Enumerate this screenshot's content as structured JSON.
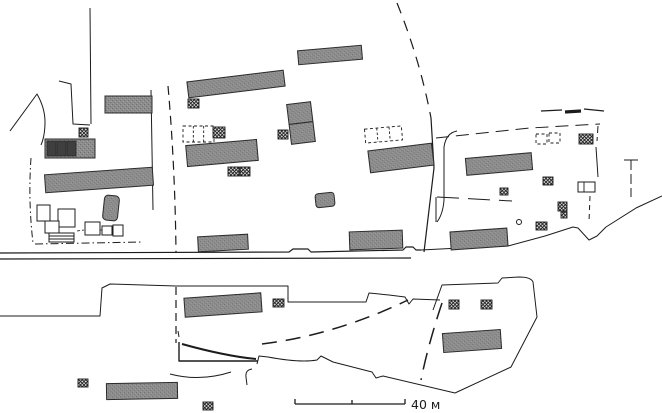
{
  "page": {
    "background": "#ffffff"
  },
  "map": {
    "width": 662,
    "height": 413,
    "colors": {
      "line": "#1c1c1c",
      "building_fill": "#8d8d8d",
      "building_noise": "#6f6f6f",
      "building_stroke": "#2b2b2b",
      "cell_fill": "#3f3f3f",
      "marker_bg": "#d6d6d6",
      "marker_line": "#1c1c1c",
      "open_fill": "#ffffff"
    },
    "scale_bar": {
      "label": "40 м",
      "bar_path": "M295,404 L405,404 M295,404 L295,399 M352,404 L352,400 M405,404 L405,399"
    },
    "buildings": [
      {
        "cx": 128.5,
        "cy": 104.5,
        "w": 47,
        "h": 17,
        "rot": 0
      },
      {
        "cx": 70,
        "cy": 148.5,
        "w": 50,
        "h": 19,
        "rot": 0
      },
      {
        "cx": 99,
        "cy": 180,
        "w": 108,
        "h": 18,
        "rot": -4
      },
      {
        "cx": 111,
        "cy": 208,
        "w": 15,
        "h": 25,
        "rot": 6,
        "rx": 4
      },
      {
        "cx": 236,
        "cy": 84,
        "w": 97,
        "h": 16,
        "rot": -7
      },
      {
        "cx": 222,
        "cy": 153,
        "w": 71,
        "h": 21,
        "rot": -5
      },
      {
        "cx": 330,
        "cy": 55,
        "w": 64,
        "h": 14,
        "rot": -5
      },
      {
        "cx": 301,
        "cy": 123,
        "w": 24,
        "h": 40,
        "rot": -7,
        "divider": true
      },
      {
        "cx": 401,
        "cy": 158,
        "w": 64,
        "h": 22,
        "rot": -7
      },
      {
        "cx": 499,
        "cy": 164,
        "w": 66,
        "h": 17,
        "rot": -5
      },
      {
        "cx": 376,
        "cy": 240,
        "w": 53,
        "h": 18,
        "rot": -2
      },
      {
        "cx": 479,
        "cy": 239,
        "w": 57,
        "h": 18,
        "rot": -4
      },
      {
        "cx": 223,
        "cy": 243,
        "w": 50,
        "h": 15,
        "rot": -3
      },
      {
        "cx": 223,
        "cy": 305,
        "w": 77,
        "h": 19,
        "rot": -4
      },
      {
        "cx": 472,
        "cy": 341,
        "w": 58,
        "h": 19,
        "rot": -4
      },
      {
        "cx": 142,
        "cy": 391,
        "w": 71,
        "h": 16,
        "rot": -1
      },
      {
        "cx": 325,
        "cy": 200,
        "w": 19,
        "h": 14,
        "rot": -6,
        "rx": 3
      }
    ],
    "building_cells": [
      {
        "x": 47,
        "y": 141,
        "w": 9,
        "h": 15
      },
      {
        "x": 57,
        "y": 141,
        "w": 9,
        "h": 15
      },
      {
        "x": 67,
        "y": 141,
        "w": 9,
        "h": 15
      }
    ],
    "markers": [
      {
        "x": 79,
        "y": 128,
        "w": 9,
        "h": 9
      },
      {
        "x": 188,
        "y": 99,
        "w": 11,
        "h": 9
      },
      {
        "x": 213,
        "y": 127,
        "w": 12,
        "h": 11
      },
      {
        "x": 228,
        "y": 167,
        "w": 11,
        "h": 9
      },
      {
        "x": 240,
        "y": 167,
        "w": 10,
        "h": 9
      },
      {
        "x": 278,
        "y": 130,
        "w": 10,
        "h": 9
      },
      {
        "x": 579,
        "y": 134,
        "w": 14,
        "h": 10
      },
      {
        "x": 543,
        "y": 177,
        "w": 10,
        "h": 8
      },
      {
        "x": 500,
        "y": 188,
        "w": 8,
        "h": 7
      },
      {
        "x": 558,
        "y": 202,
        "w": 9,
        "h": 9
      },
      {
        "x": 561,
        "y": 212,
        "w": 6,
        "h": 6
      },
      {
        "x": 536,
        "y": 222,
        "w": 11,
        "h": 8
      },
      {
        "x": 273,
        "y": 299,
        "w": 11,
        "h": 8
      },
      {
        "x": 449,
        "y": 300,
        "w": 10,
        "h": 9
      },
      {
        "x": 481,
        "y": 300,
        "w": 11,
        "h": 9
      },
      {
        "x": 78,
        "y": 379,
        "w": 10,
        "h": 8
      },
      {
        "x": 203,
        "y": 402,
        "w": 10,
        "h": 8
      }
    ],
    "open_rects": [
      {
        "x": 37,
        "y": 205,
        "w": 13,
        "h": 16
      },
      {
        "x": 58,
        "y": 209,
        "w": 17,
        "h": 18
      },
      {
        "x": 45,
        "y": 221,
        "w": 14,
        "h": 12
      },
      {
        "x": 49,
        "y": 233,
        "w": 25,
        "h": 9,
        "stripes": 2
      },
      {
        "x": 85,
        "y": 222,
        "w": 15,
        "h": 13
      },
      {
        "x": 102,
        "y": 226,
        "w": 10,
        "h": 9
      },
      {
        "x": 113,
        "y": 225,
        "w": 10,
        "h": 11
      },
      {
        "x": 578,
        "y": 182,
        "w": 17,
        "h": 10,
        "divider_x": 584
      }
    ],
    "dashed_rects": [
      {
        "cx": 198.5,
        "cy": 134,
        "w": 31,
        "h": 16,
        "rot": 0,
        "dividers": 2
      },
      {
        "cx": 383.5,
        "cy": 134.5,
        "w": 37,
        "h": 14,
        "rot": -5,
        "dividers": 2
      },
      {
        "cx": 541.5,
        "cy": 139,
        "w": 11,
        "h": 10,
        "rot": 0,
        "dividers": 0
      },
      {
        "cx": 554.5,
        "cy": 138,
        "w": 11,
        "h": 10,
        "rot": 0,
        "dividers": 0
      }
    ],
    "circles": [
      {
        "cx": 519,
        "cy": 222,
        "r": 2.5
      }
    ],
    "lines": [
      {
        "name": "road-upper-line",
        "d": "M0,253 L289,252 L293,249 L308,249 L311,252 L403,250 L406,247 L413,247 L416,250 L421,250",
        "w": 1.2
      },
      {
        "name": "road-lower-line",
        "d": "M0,259 L411,258",
        "w": 1.2
      },
      {
        "name": "shoreline",
        "d": "M421,250 L460,248 L508,246 L545,236 L573,227 L578,228 L589,240 L597,236 L606,227 L636,208 L662,196",
        "w": 1
      },
      {
        "name": "enclosure-wall",
        "d": "M90,8 L91,124",
        "w": 1
      },
      {
        "name": "enclosure-wall",
        "d": "M59,81 L71,84 L73,124 L90,125",
        "w": 1
      },
      {
        "name": "west-boundary",
        "d": "M10,131 L37,94 Q45,108 45,122 Q45,136 41,145",
        "w": 1
      },
      {
        "name": "west-boundary-dashed",
        "d": "M31,158 Q28,200 33,243",
        "dash": "7 3 1.5 3",
        "w": 1
      },
      {
        "name": "south-boundary-dashed",
        "d": "M35,244 L143,242",
        "dash": "8 3 1.5 3",
        "w": 1
      },
      {
        "name": "plot-divider-line",
        "d": "M151,90 L153,210",
        "w": 1
      },
      {
        "name": "plot-divider-dashed",
        "d": "M168,86 Q175,165 176,252",
        "dash": "9 6",
        "w": 1.2
      },
      {
        "name": "plot-divider-dashed",
        "d": "M176,287 L176,343",
        "dash": "8 5",
        "w": 1.2
      },
      {
        "name": "east-plot-boundary-dashed",
        "d": "M397,3 Q420,60 431,118",
        "dash": "11 8",
        "w": 1.2
      },
      {
        "name": "east-plot-boundary",
        "d": "M431,118 L434,168 L424,252",
        "w": 1.2
      },
      {
        "name": "lane-boundary",
        "d": "M457,131 Q446,133 444,147 L444,200 Q443,214 437,222",
        "w": 1
      },
      {
        "name": "north-boundary-dashed",
        "d": "M436,138 L530,128 L600,124",
        "dash": "13 7",
        "w": 1
      },
      {
        "name": "north-boundary-dashed",
        "d": "M598,126 L597,141",
        "dash": "7 4",
        "w": 1
      },
      {
        "name": "fence-line",
        "d": "M596,147 L598,177",
        "w": 1
      },
      {
        "name": "pole-marker",
        "d": "M624,160 L638,160",
        "w": 1
      },
      {
        "name": "pole-marker",
        "d": "M631,160 L631,197",
        "dash": "10 4",
        "w": 1
      },
      {
        "name": "field-dash",
        "d": "M541,111 L562,110",
        "w": 1.2
      },
      {
        "name": "field-dash-thick",
        "d": "M565,112 L581,111",
        "w": 3.2
      },
      {
        "name": "field-dash",
        "d": "M584,109 L604,111",
        "w": 1.2
      },
      {
        "name": "fence-line",
        "d": "M436,222 L436,197",
        "w": 1
      },
      {
        "name": "fence-dashed",
        "d": "M437,197 L512,201",
        "dash": "22 9",
        "w": 1
      },
      {
        "name": "south-parcel-outline",
        "d": "M0,316 L100,316 L102,288 L110,284 L176,286 L288,286 L288,302 L366,302 L369,293 L389,295 L405,297 L409,304 L413,299 L440,300",
        "w": 1
      },
      {
        "name": "southeast-parcel-outline",
        "d": "M433,310 L442,285 L498,283 L502,278 L519,277 Q531,277 533,282 L537,317 L511,367 L455,393",
        "w": 1
      },
      {
        "name": "south-boundary-line",
        "d": "M257,364 L259,356 L268,357 Q300,363 317,360 L321,356 L333,362 L372,372 L376,378 L383,376 L455,393",
        "w": 1
      },
      {
        "name": "track-dashed",
        "d": "M262,344 Q335,335 408,300",
        "dash": "15 9",
        "w": 1.5
      },
      {
        "name": "track-dashed",
        "d": "M442,303 Q428,345 421,380",
        "dash": "17 9",
        "w": 1.5
      },
      {
        "name": "ramp-structure",
        "d": "M179,342 L179,361 L258,361",
        "w": 1.4
      },
      {
        "name": "ramp-structure",
        "d": "M182,344 Q225,356 256,359",
        "w": 2
      },
      {
        "name": "ramp-structure",
        "d": "M178,331 L179,337",
        "w": 1
      },
      {
        "name": "path-curve",
        "d": "M170,374 Q200,382 231,372",
        "w": 1
      },
      {
        "name": "path-curve",
        "d": "M252,369 Q245,370 246,377 L247,385",
        "w": 1
      },
      {
        "name": "fence-dashed",
        "d": "M590,196 L589,222",
        "dash": "5 4",
        "w": 1
      },
      {
        "name": "connector-dash",
        "d": "M77,231 L84,230",
        "dash": "3 2",
        "w": 0.8
      },
      {
        "name": "connector-dash",
        "d": "M100,230 L113,230",
        "dash": "3 2",
        "w": 0.8
      }
    ]
  }
}
